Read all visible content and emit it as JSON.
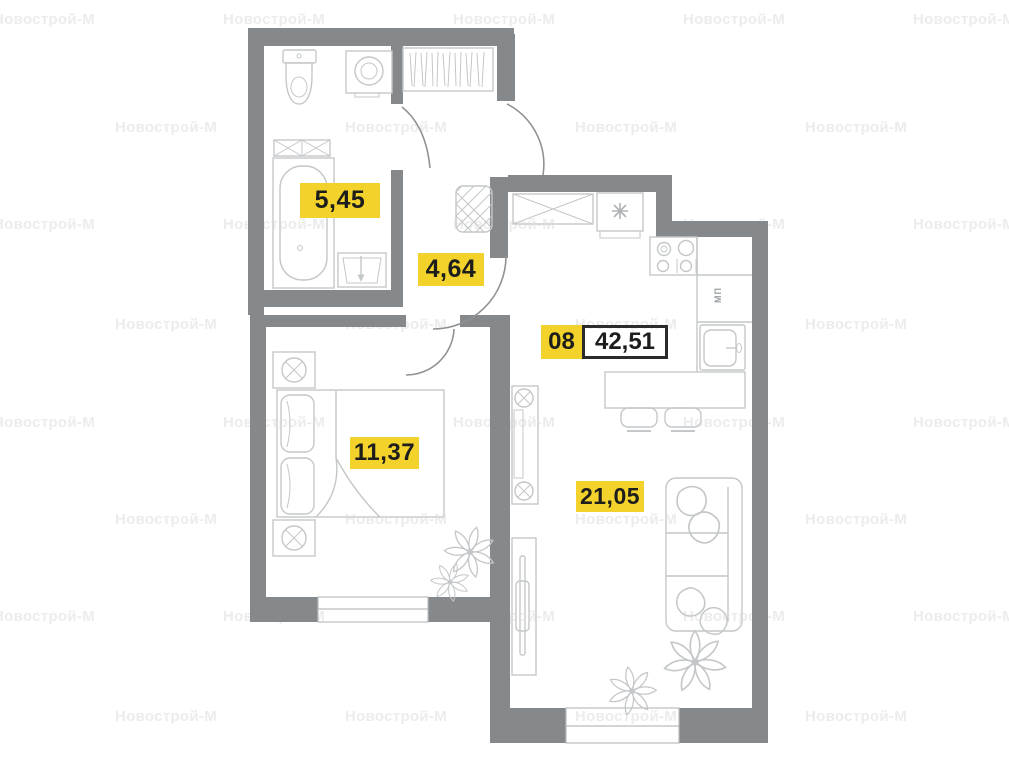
{
  "plan": {
    "watermark_text": "Новострой-М",
    "unit_label": {
      "number": "08",
      "area": "42,51"
    },
    "rooms": [
      {
        "id": "bathroom",
        "area": "5,45"
      },
      {
        "id": "hallway",
        "area": "4,64"
      },
      {
        "id": "bedroom",
        "area": "11,37"
      },
      {
        "id": "living-kitchen",
        "area": "21,05"
      }
    ],
    "kitchen_text": "МП",
    "colors": {
      "accent_yellow": "#f3d32b",
      "wall_gray": "#85898c",
      "furniture_gray": "#c4c7c9",
      "watermark_gray": "#ececec",
      "label_text": "#1d1d1b"
    },
    "watermarks": {
      "rows": [
        {
          "y": 11,
          "xs": [
            -7,
            223,
            453,
            683,
            913
          ]
        },
        {
          "y": 119,
          "xs": [
            115,
            345,
            575,
            805
          ]
        },
        {
          "y": 216,
          "xs": [
            -7,
            223,
            453,
            683,
            913
          ]
        },
        {
          "y": 316,
          "xs": [
            115,
            345,
            575,
            805
          ]
        },
        {
          "y": 414,
          "xs": [
            -7,
            223,
            453,
            683,
            913
          ]
        },
        {
          "y": 511,
          "xs": [
            115,
            345,
            575,
            805
          ]
        },
        {
          "y": 608,
          "xs": [
            -7,
            223,
            453,
            683,
            913
          ]
        },
        {
          "y": 708,
          "xs": [
            115,
            345,
            575,
            805
          ]
        }
      ]
    }
  }
}
